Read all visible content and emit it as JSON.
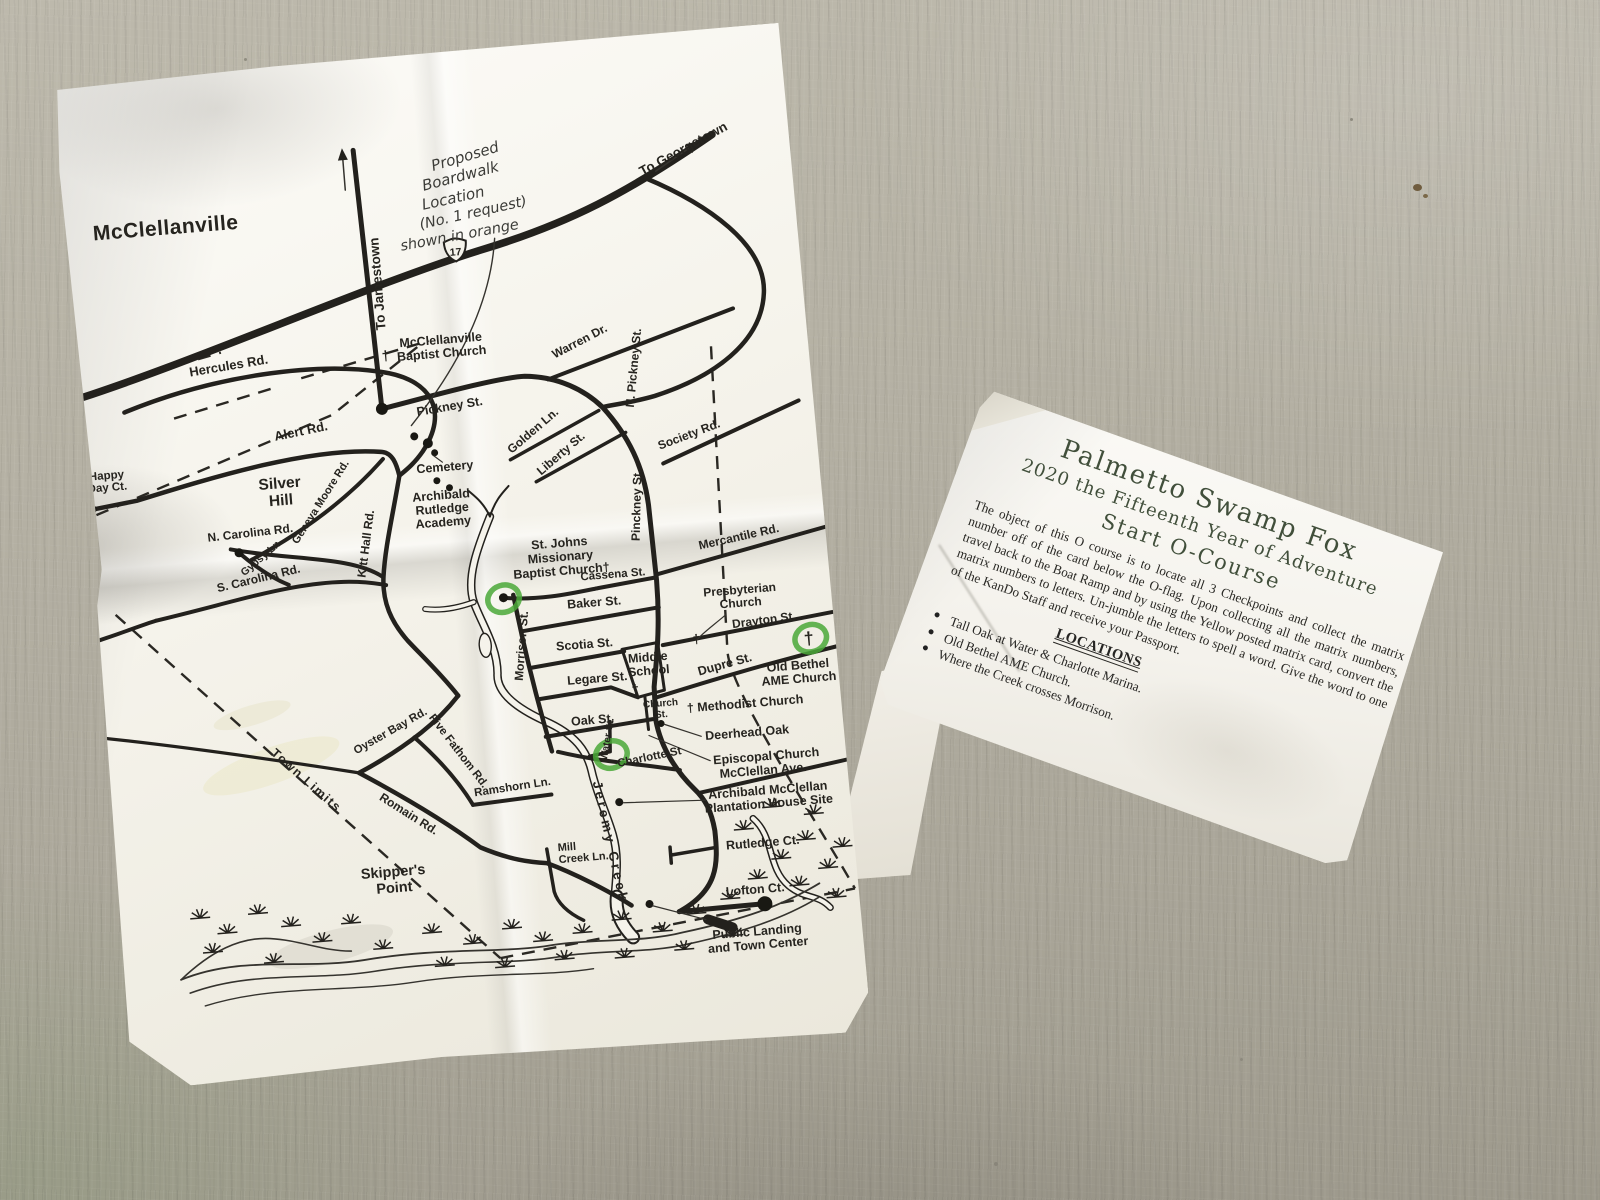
{
  "scene": {
    "floor_color": "#b4b0a3",
    "floor_shadow_color": "#9d998c"
  },
  "map_paper": {
    "paper_color": "#f5f3eb",
    "ink_color": "#26241f",
    "route_shield": "17",
    "checkpoint_color": "#4aa838",
    "checkpoints": [
      {
        "x": 410,
        "y": 552
      },
      {
        "x": 713,
        "y": 616
      },
      {
        "x": 505,
        "y": 716
      }
    ],
    "labels": [
      {
        "t": "McClellanville",
        "x": 30,
        "y": 162,
        "s": 21,
        "a": "s",
        "ls": 0.5
      },
      {
        "t": "To Jamestown",
        "x": 314,
        "y": 228,
        "s": 13.5,
        "r": -90
      },
      {
        "t": "To Georgetown",
        "x": 627,
        "y": 122,
        "s": 13.5,
        "r": -24
      },
      {
        "t": "Hercules Rd.",
        "x": 155,
        "y": 302,
        "s": 13,
        "r": -5
      },
      {
        "t": [
          "Happy",
          "Day Ct."
        ],
        "x": 24,
        "y": 401,
        "s": 11.5,
        "lh": 12
      },
      {
        "t": "Alert Rd.",
        "x": 222,
        "y": 373,
        "s": 13,
        "r": -7
      },
      {
        "t": "Geneva Moore Rd.",
        "x": 238,
        "y": 443,
        "s": 11,
        "r": -53
      },
      {
        "t": "Gypsy Ln.",
        "x": 174,
        "y": 494,
        "s": 10.5,
        "r": -36
      },
      {
        "t": [
          "Silver",
          "Hill"
        ],
        "x": 196,
        "y": 424,
        "s": 15.5,
        "lh": 17
      },
      {
        "t": "N. Carolina Rd.",
        "x": 163,
        "y": 470,
        "s": 12,
        "r": -2
      },
      {
        "t": "S. Carolina Rd.",
        "x": 168,
        "y": 516,
        "s": 12,
        "r": -9
      },
      {
        "t": "Kitt Hall Rd.",
        "x": 281,
        "y": 487,
        "s": 12,
        "r": -78
      },
      {
        "t": [
          "McClellanville",
          "Baptist Church"
        ],
        "x": 368,
        "y": 293,
        "s": 12.5,
        "lh": 13.5
      },
      {
        "t": "†",
        "x": 312,
        "y": 305,
        "s": 14
      },
      {
        "t": "Pickney St.",
        "x": 372,
        "y": 360,
        "s": 12.5,
        "r": -5
      },
      {
        "t": "Warren Dr.",
        "x": 508,
        "y": 305,
        "s": 12,
        "r": -23
      },
      {
        "t": "N. Pickney St.",
        "x": 562,
        "y": 333,
        "s": 12,
        "r": -80
      },
      {
        "t": "Golden Ln.",
        "x": 455,
        "y": 390,
        "s": 12,
        "r": -36
      },
      {
        "t": "Liberty St.",
        "x": 481,
        "y": 415,
        "s": 12,
        "r": -36
      },
      {
        "t": "Society Rd.",
        "x": 609,
        "y": 407,
        "s": 12,
        "r": -16
      },
      {
        "t": "Cemetery",
        "x": 362,
        "y": 420,
        "s": 12.5
      },
      {
        "t": [
          "Archibald",
          "Rutledge",
          "Academy"
        ],
        "x": 356,
        "y": 448,
        "s": 12.5,
        "lh": 13.5
      },
      {
        "t": "Pinckney St.",
        "x": 554,
        "y": 470,
        "s": 12,
        "r": -84
      },
      {
        "t": [
          "St. Johns",
          "Missionary",
          "Baptist Church†"
        ],
        "x": 470,
        "y": 505,
        "s": 12.5,
        "lh": 14
      },
      {
        "t": "Cassena St.",
        "x": 521,
        "y": 540,
        "s": 11.5
      },
      {
        "t": "Mercantile Rd.",
        "x": 650,
        "y": 513,
        "s": 12,
        "r": -8
      },
      {
        "t": "Baker St.",
        "x": 500,
        "y": 567,
        "s": 12.5
      },
      {
        "t": [
          "Presbyterian",
          "Church"
        ],
        "x": 646,
        "y": 566,
        "s": 12,
        "lh": 13
      },
      {
        "t": "Scotia St.",
        "x": 487,
        "y": 608,
        "s": 12.5
      },
      {
        "t": "Drayton St.",
        "x": 668,
        "y": 598,
        "s": 12,
        "r": -3
      },
      {
        "t": "Morrison St.",
        "x": 428,
        "y": 601,
        "s": 12,
        "r": -81
      },
      {
        "t": "Legare St.",
        "x": 497,
        "y": 643,
        "s": 12.5
      },
      {
        "t": [
          "Middle",
          "School"
        ],
        "x": 549,
        "y": 626,
        "s": 12.5,
        "lh": 13.5
      },
      {
        "t": [
          "Church",
          "St."
        ],
        "x": 558,
        "y": 672,
        "s": 10,
        "lh": 11
      },
      {
        "t": "†",
        "x": 534,
        "y": 657,
        "s": 13
      },
      {
        "t": "†",
        "x": 599,
        "y": 612,
        "s": 13
      },
      {
        "t": "Dupre St.",
        "x": 626,
        "y": 639,
        "s": 12.5,
        "r": -11
      },
      {
        "t": [
          "Old Bethel",
          "AME Church"
        ],
        "x": 698,
        "y": 646,
        "s": 12.5,
        "lh": 13.5
      },
      {
        "t": "†",
        "x": 711,
        "y": 622,
        "s": 18
      },
      {
        "t": "Oak St.",
        "x": 489,
        "y": 684,
        "s": 12.5
      },
      {
        "t": "† Methodist Church",
        "x": 584,
        "y": 680,
        "s": 12.5,
        "a": "s"
      },
      {
        "t": "Deerhead Oak",
        "x": 600,
        "y": 709,
        "s": 12.5,
        "a": "s"
      },
      {
        "t": "Episcopal Church",
        "x": 606,
        "y": 734,
        "s": 12.5,
        "a": "s"
      },
      {
        "t": "Water St.",
        "x": 505,
        "y": 701,
        "s": 10,
        "r": -76
      },
      {
        "t": "Charlotte St",
        "x": 543,
        "y": 725,
        "s": 11.5,
        "r": -7
      },
      {
        "t": "McClellan Ave.",
        "x": 655,
        "y": 748,
        "s": 12.5
      },
      {
        "t": [
          "Archibald McClellan",
          "Plantation House Site"
        ],
        "x": 658,
        "y": 768,
        "s": 12.5,
        "lh": 13.5
      },
      {
        "t": "Rutledge Ct.",
        "x": 612,
        "y": 820,
        "s": 12.5,
        "a": "s"
      },
      {
        "t": "Lofton Ct.",
        "x": 608,
        "y": 866,
        "s": 12.5,
        "a": "s"
      },
      {
        "t": [
          "Public Landing",
          "and Town Center"
        ],
        "x": 636,
        "y": 908,
        "s": 12.5,
        "lh": 13.5
      },
      {
        "t": "Jeremy Creek",
        "x": 484,
        "y": 742,
        "s": 13.5,
        "r": 82,
        "ls": 3,
        "a": "s"
      },
      {
        "t": [
          "Mill",
          "Creek Ln."
        ],
        "x": 444,
        "y": 808,
        "s": 11,
        "lh": 12,
        "a": "s"
      },
      {
        "t": [
          "Skipper's",
          "Point"
        ],
        "x": 278,
        "y": 820,
        "s": 14.5,
        "lh": 16
      },
      {
        "t": "Romain  Rd.",
        "x": 296,
        "y": 762,
        "s": 12,
        "r": 37
      },
      {
        "t": "Ramshorn Ln.",
        "x": 404,
        "y": 744,
        "s": 11.5,
        "r": -4
      },
      {
        "t": "Oyster Bay Rd.",
        "x": 288,
        "y": 678,
        "s": 11.5,
        "r": -25
      },
      {
        "t": "Five Fathom Rd.",
        "x": 350,
        "y": 702,
        "s": 11.5,
        "r": 57
      },
      {
        "t": "Town Limits",
        "x": 196,
        "y": 720,
        "s": 12.5,
        "r": 46,
        "ls": 1.5
      },
      {
        "t": "Proposed",
        "x": 374,
        "y": 120,
        "s": 15,
        "r": -12,
        "f": "hand",
        "a": "s"
      },
      {
        "t": "Boardwalk",
        "x": 363,
        "y": 139,
        "s": 15,
        "r": -10,
        "f": "hand",
        "a": "s"
      },
      {
        "t": "Location",
        "x": 361,
        "y": 158,
        "s": 15,
        "r": -8,
        "f": "hand",
        "a": "s"
      },
      {
        "t": "(No. 1 request)",
        "x": 357,
        "y": 177,
        "s": 14.5,
        "r": -8,
        "f": "hand",
        "a": "s"
      },
      {
        "t": "shown in orange",
        "x": 336,
        "y": 197,
        "s": 14.5,
        "r": -6,
        "f": "hand",
        "a": "s"
      }
    ]
  },
  "card": {
    "title_line1": "Palmetto Swamp Fox",
    "title_line2": "2020 the Fifteenth Year of Adventure",
    "title_line3": "Start O-Course",
    "body": "The object of this O course is to locate all 3 Checkpoints and collect the matrix number off of the card below the O-flag. Upon collecting all the matrix numbers, travel back to the Boat Ramp and by using the Yellow posted matrix card, convert the matrix numbers to letters.  Un-jumble the letters to spell a word. Give the word to one of the KanDo Staff and receive your Passport.",
    "locations_heading": "LOCATIONS",
    "locations": [
      "Tall Oak at Water & Charlotte Marina.",
      "Old Bethel AME Church.",
      "Where the Creek crosses Morrison."
    ],
    "title_color": "#414f3b"
  }
}
